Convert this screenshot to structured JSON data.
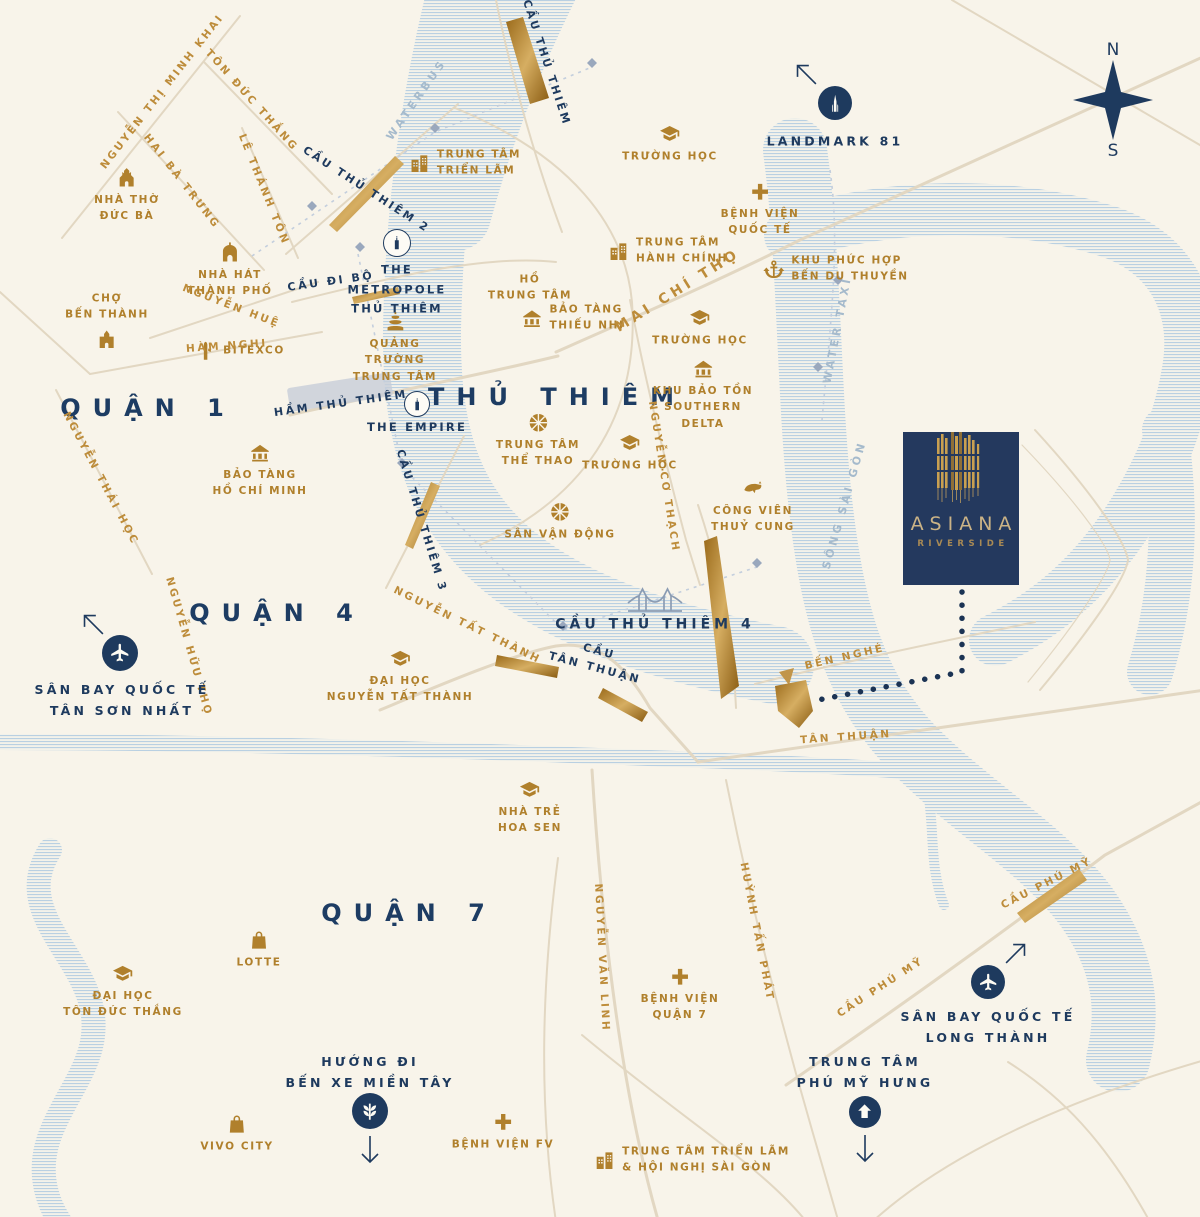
{
  "project": {
    "name": "ASIANA",
    "subtitle": "RIVERSIDE"
  },
  "compass": {
    "north": "N",
    "south": "S"
  },
  "colors": {
    "background": "#f8f4ea",
    "navy": "#1e3a5e",
    "gold": "#b0802c",
    "road": "#e2d7c2",
    "water_line": "#b9d0e2",
    "bridge_gold": "#a9791f",
    "water_label": "#a5bacc",
    "district": "#1d3c63"
  },
  "map": {
    "districts": [
      {
        "id": "quan-1",
        "label": "QUẬN 1",
        "x": 148,
        "y": 408
      },
      {
        "id": "thu-thiem",
        "label": "THỦ THIÊM",
        "x": 557,
        "y": 397
      },
      {
        "id": "quan-4",
        "label": "QUẬN 4",
        "x": 277,
        "y": 613
      },
      {
        "id": "quan-7",
        "label": "QUẬN 7",
        "x": 409,
        "y": 913
      }
    ],
    "pois": [
      {
        "id": "nha-tho-duc-ba",
        "label": "NHÀ THỜ\nĐỨC BÀ",
        "icon": "church",
        "layout": "top",
        "x": 127,
        "y": 196
      },
      {
        "id": "nha-hat-thanh-pho",
        "label": "NHÀ HÁT\nTHÀNH PHỐ",
        "icon": "theater",
        "layout": "top",
        "x": 230,
        "y": 271
      },
      {
        "id": "cho-ben-thanh",
        "label": "CHỢ\nBẾN THÀNH",
        "icon": "market",
        "layout": "bottom",
        "x": 107,
        "y": 320
      },
      {
        "id": "bitexco",
        "label": "BITEXCO",
        "icon": "tower",
        "layout": "left",
        "x": 240,
        "y": 351
      },
      {
        "id": "bao-tang-ho-chi-minh",
        "label": "BẢO TÀNG\nHỒ CHÍ MINH",
        "icon": "museum",
        "layout": "top",
        "x": 260,
        "y": 471
      },
      {
        "id": "trung-tam-trien-lam",
        "label": "TRUNG TÂM\nTRIỂN LÃM",
        "icon": "building",
        "layout": "left",
        "x": 465,
        "y": 163
      },
      {
        "id": "truong-hoc-1",
        "label": "TRƯỜNG HỌC",
        "icon": "school",
        "layout": "top",
        "x": 670,
        "y": 144
      },
      {
        "id": "benh-vien-quoc-te",
        "label": "BỆNH VIỆN\nQUỐC TẾ",
        "icon": "hospital",
        "layout": "top",
        "x": 760,
        "y": 210
      },
      {
        "id": "trung-tam-hanh-chinh",
        "label": "TRUNG TÂM\nHÀNH CHÍNH",
        "icon": "building",
        "layout": "left",
        "x": 668,
        "y": 251
      },
      {
        "id": "khu-phuc-hop-ben-du-thuyen",
        "label": "KHU PHỨC HỢP\nBẾN DU THUYỀN",
        "icon": "anchor",
        "layout": "left",
        "x": 836,
        "y": 269
      },
      {
        "id": "ho-trung-tam",
        "label": "HỒ\nTRUNG TÂM",
        "icon": null,
        "layout": "top",
        "x": 530,
        "y": 288
      },
      {
        "id": "bao-tang-thieu-nhi",
        "label": "BẢO TÀNG\nTHIẾU NHI",
        "icon": "museum",
        "layout": "left",
        "x": 573,
        "y": 318
      },
      {
        "id": "truong-hoc-2",
        "label": "TRƯỜNG HỌC",
        "icon": "school",
        "layout": "top",
        "x": 700,
        "y": 328
      },
      {
        "id": "quang-truong-trung-tam",
        "label": "QUẢNG\nTRƯỜNG\nTRUNG TÂM",
        "icon": "fountain",
        "layout": "top",
        "x": 395,
        "y": 348
      },
      {
        "id": "khu-bao-ton-southern-delta",
        "label": "KHU BẢO TỒN\nSOUTHERN\nDELTA",
        "icon": "museum",
        "layout": "top",
        "x": 703,
        "y": 395
      },
      {
        "id": "trung-tam-the-thao",
        "label": "TRUNG TÂM\nTHỂ THAO",
        "icon": "ball",
        "layout": "top",
        "x": 538,
        "y": 441
      },
      {
        "id": "truong-hoc-3",
        "label": "TRƯỜNG HỌC",
        "icon": "school",
        "layout": "top",
        "x": 630,
        "y": 453
      },
      {
        "id": "san-van-dong",
        "label": "SÂN VẬN ĐỘNG",
        "icon": "ball",
        "layout": "top",
        "x": 560,
        "y": 522
      },
      {
        "id": "cong-vien-thuy-cung",
        "label": "CÔNG VIÊN\nTHUỶ CUNG",
        "icon": "whale",
        "layout": "top",
        "x": 753,
        "y": 507
      },
      {
        "id": "dai-hoc-nguyen-tat-thanh",
        "label": "ĐẠI HỌC\nNGUYỄN TẤT THÀNH",
        "icon": "school",
        "layout": "top",
        "x": 400,
        "y": 677
      },
      {
        "id": "nha-tre-hoa-sen",
        "label": "NHÀ TRẺ\nHOA SEN",
        "icon": "school",
        "layout": "top",
        "x": 530,
        "y": 808
      },
      {
        "id": "lotte",
        "label": "LOTTE",
        "icon": "bag",
        "layout": "top",
        "x": 259,
        "y": 950
      },
      {
        "id": "dai-hoc-ton-duc-thang",
        "label": "ĐẠI HỌC\nTÔN ĐỨC THẮNG",
        "icon": "school",
        "layout": "top",
        "x": 123,
        "y": 992
      },
      {
        "id": "vivo-city",
        "label": "VIVO CITY",
        "icon": "bag",
        "layout": "top",
        "x": 237,
        "y": 1134
      },
      {
        "id": "benh-vien-quan-7",
        "label": "BỆNH VIỆN\nQUẬN 7",
        "icon": "hospital",
        "layout": "top",
        "x": 680,
        "y": 995
      },
      {
        "id": "benh-vien-fv",
        "label": "BỆNH VIỆN FV",
        "icon": "hospital",
        "layout": "top",
        "x": 503,
        "y": 1132
      },
      {
        "id": "tt-trien-lam-hoi-nghi-sai-gon",
        "label": "TRUNG TÂM TRIỂN LÃM\n& HỘI NGHỊ SÀI GÒN",
        "icon": "building",
        "layout": "left",
        "x": 692,
        "y": 1160
      }
    ],
    "road_labels": [
      {
        "id": "nguyen-thi-minh-khai",
        "label": "NGUYỄN THỊ MINH KHAI",
        "style": "gold",
        "x": 163,
        "y": 92,
        "rot": -52
      },
      {
        "id": "ton-duc-thang",
        "label": "TÔN ĐỨC THẮNG",
        "style": "gold",
        "x": 251,
        "y": 101,
        "rot": 48
      },
      {
        "id": "hai-ba-trung",
        "label": "HAI BÀ TRƯNG",
        "style": "gold",
        "x": 181,
        "y": 182,
        "rot": 52
      },
      {
        "id": "le-thanh-ton",
        "label": "LÊ THÁNH TÔN",
        "style": "gold",
        "x": 263,
        "y": 190,
        "rot": 68
      },
      {
        "id": "nguyen-hue",
        "label": "NGUYỄN HUỆ",
        "style": "gold",
        "x": 231,
        "y": 307,
        "rot": 21
      },
      {
        "id": "ham-nghi",
        "label": "HÀM NGHI",
        "style": "gold",
        "x": 227,
        "y": 347,
        "rot": -4
      },
      {
        "id": "nguyen-thai-hoc",
        "label": "NGUYỄN THÁI HỌC",
        "style": "gold",
        "x": 100,
        "y": 479,
        "rot": 62
      },
      {
        "id": "nguyen-huu-tho",
        "label": "NGUYỄN HỮU THỌ",
        "style": "gold",
        "x": 188,
        "y": 647,
        "rot": 74
      },
      {
        "id": "mai-chi-tho",
        "label": "MAI CHÍ THỌ",
        "style": "gold big",
        "x": 678,
        "y": 291,
        "rot": -32
      },
      {
        "id": "nguyen-co-thach",
        "label": "NGUYỄN CƠ THẠCH",
        "style": "gold",
        "x": 663,
        "y": 477,
        "rot": 81
      },
      {
        "id": "ben-nghe",
        "label": "BẾN NGHÉ",
        "style": "gold",
        "x": 845,
        "y": 658,
        "rot": -13
      },
      {
        "id": "tan-thuan",
        "label": "TÂN THUẬN",
        "style": "gold",
        "x": 846,
        "y": 738,
        "rot": -4
      },
      {
        "id": "nguyen-tat-thanh",
        "label": "NGUYỄN TẤT THÀNH",
        "style": "gold",
        "x": 467,
        "y": 626,
        "rot": 26
      },
      {
        "id": "nguyen-van-linh",
        "label": "NGUYỄN VĂN LINH",
        "style": "gold",
        "x": 601,
        "y": 958,
        "rot": 87
      },
      {
        "id": "huynh-tan-phat",
        "label": "HUỲNH TẤN PHÁT",
        "style": "gold",
        "x": 756,
        "y": 932,
        "rot": 79
      },
      {
        "id": "cau-phu-my-1",
        "label": "CẦU PHÚ MỸ",
        "style": "gold",
        "x": 881,
        "y": 988,
        "rot": -33
      },
      {
        "id": "cau-phu-my-2",
        "label": "CẦU PHÚ MỸ",
        "style": "gold",
        "x": 1047,
        "y": 884,
        "rot": -27
      },
      {
        "id": "cau-thu-thiem",
        "label": "CẦU THỦ THIÊM",
        "style": "navy",
        "x": 546,
        "y": 63,
        "rot": 72
      },
      {
        "id": "cau-thu-thiem-2",
        "label": "CẦU THỦ THIÊM 2",
        "style": "navy",
        "x": 366,
        "y": 190,
        "rot": 33
      },
      {
        "id": "cau-di-bo",
        "label": "CẦU ĐI BỘ",
        "style": "navy",
        "x": 331,
        "y": 282,
        "rot": -8
      },
      {
        "id": "ham-thu-thiem",
        "label": "HẦM THỦ THIÊM",
        "style": "navy",
        "x": 341,
        "y": 404,
        "rot": -8
      },
      {
        "id": "cau-thu-thiem-3",
        "label": "CẦU THỦ THIÊM 3",
        "style": "navy",
        "x": 421,
        "y": 521,
        "rot": 73
      },
      {
        "id": "cau-thu-thiem-4",
        "label": "CẦU THỦ THIÊM 4",
        "style": "navy big",
        "x": 655,
        "y": 625,
        "rot": 0
      },
      {
        "id": "cau-tan-thuan",
        "label": "CẦU\nTÂN THUẬN",
        "style": "navy",
        "x": 597,
        "y": 660,
        "rot": 15
      },
      {
        "id": "waterbus",
        "label": "WATERBUS",
        "style": "water",
        "x": 417,
        "y": 100,
        "rot": -55
      },
      {
        "id": "water-taxi",
        "label": "WATER TAXI",
        "style": "water",
        "x": 838,
        "y": 330,
        "rot": -79
      },
      {
        "id": "song-sai-gon",
        "label": "SÔNG SÀI GÒN",
        "style": "water",
        "x": 845,
        "y": 505,
        "rot": -74
      }
    ],
    "markers": [
      {
        "id": "landmark-81",
        "label": "LANDMARK 81",
        "variant": "solid",
        "icon": "tower81",
        "cx": 835,
        "cy": 103,
        "r": 17,
        "lx": 835,
        "ly": 141,
        "wide": true,
        "arrow": {
          "x": 806,
          "y": 74,
          "rot": -45
        }
      },
      {
        "id": "the-metropole-thu-thiem",
        "label": "THE\nMETROPOLE\nTHỦ THIÊM",
        "variant": "ring",
        "icon": "mbuild",
        "cx": 397,
        "cy": 243,
        "r": 13,
        "lx": 397,
        "ly": 290
      },
      {
        "id": "the-empire",
        "label": "THE EMPIRE",
        "variant": "ring",
        "icon": "mbuild",
        "cx": 417,
        "cy": 404,
        "r": 12,
        "lx": 417,
        "ly": 428
      },
      {
        "id": "san-bay-tan-son-nhat",
        "label": "SÂN BAY QUỐC TẾ\nTÂN SƠN NHẤT",
        "variant": "solid",
        "icon": "plane",
        "cx": 120,
        "cy": 653,
        "r": 18,
        "lx": 122,
        "ly": 700,
        "wide": true,
        "arrow": {
          "x": 93,
          "y": 624,
          "rot": -45
        }
      },
      {
        "id": "san-bay-long-thanh",
        "label": "SÂN BAY QUỐC TẾ\nLONG THÀNH",
        "variant": "solid",
        "icon": "plane",
        "cx": 988,
        "cy": 982,
        "r": 17,
        "lx": 988,
        "ly": 1027,
        "wide": true,
        "arrow": {
          "x": 1016,
          "y": 953,
          "rot": 45
        }
      },
      {
        "id": "ben-xe-mien-tay",
        "label": "HƯỚNG ĐI\nBẾN XE MIỀN TÂY",
        "variant": "solid",
        "icon": "wheat",
        "cx": 370,
        "cy": 1111,
        "r": 18,
        "lx": 370,
        "ly": 1072,
        "wide": true,
        "arrow": {
          "x": 370,
          "y": 1150,
          "rot": 180
        }
      },
      {
        "id": "trung-tam-phu-my-hung",
        "label": "TRUNG TÂM\nPHÚ MỸ HƯNG",
        "variant": "solid",
        "icon": "housearrow",
        "cx": 865,
        "cy": 1112,
        "r": 16,
        "lx": 865,
        "ly": 1072,
        "wide": true,
        "arrow": {
          "x": 865,
          "y": 1149,
          "rot": 180
        }
      }
    ]
  }
}
